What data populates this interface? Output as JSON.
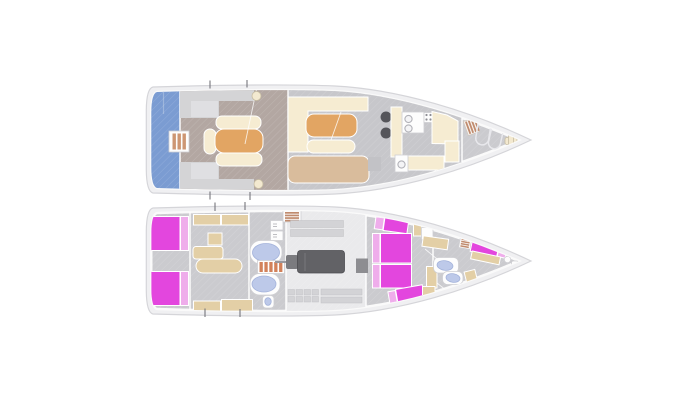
{
  "diagram": {
    "title": "Sailing yacht deck plans",
    "views": [
      {
        "id": "upper-deck",
        "label": "Upper deck / exterior and saloon plan",
        "features": [
          "swim-platform",
          "boarding-ladder",
          "cockpit-bench-seating",
          "cockpit-sunpad",
          "helm-winches",
          "saloon-settee",
          "saloon-table",
          "saloon-sofa",
          "galley-stove",
          "galley-sink",
          "galley-counters",
          "companionway-steps",
          "foredeck-hatches",
          "anchor-windlass"
        ]
      },
      {
        "id": "lower-deck",
        "label": "Lower deck / accommodation plan",
        "features": [
          "aft-cabin-berths",
          "wardrobes",
          "bathtub",
          "shower-tub",
          "companion-stairs",
          "toilet",
          "engine-room",
          "main-engine",
          "storage-grid",
          "guest-cabin-berths",
          "forward-double-berths",
          "washbasins",
          "bow-v-berth",
          "louvered-lockers"
        ]
      }
    ]
  },
  "palette": {
    "canvas": "#ffffff",
    "hullOuter": "#f0f0f2",
    "hullStroke": "#d5d5d9",
    "rim": "#fafafa",
    "deck": "#cbcbcf",
    "floorCockpit": "#b3a7a2",
    "floorSalon": "#c7c7cb",
    "floorEngine": "#eaeaec",
    "blue": "#7b9cd2",
    "stay": "#9db6dc",
    "gray1": "#d4d4d6",
    "gray2": "#dfdfe2",
    "cream": "#f6ecd2",
    "sand": "#e3cfa6",
    "tan": "#d9bc9c",
    "orange": "#e2a563",
    "magenta": "#e346de",
    "pink": "#efadeb",
    "ltblue": "#bdc9e9",
    "ltblueStroke": "#a3b2da",
    "fixture": "#fdfdfd",
    "fixtureStroke": "#cfcfd3",
    "dark": "#55555a",
    "engine": "#626266",
    "engineStroke": "#4c4c50",
    "gearbox": "#7b7b7f",
    "shaft": "#98989e",
    "shelf": "#d3d3d6",
    "shelfStroke": "#c0c0c4",
    "stairOrange": "#d2815a",
    "louverBrown": "#c08b6e",
    "ladderStripe": "#cd9673",
    "winch": "#f3e9d0",
    "winchStroke": "#c6bca2",
    "ringStroke": "#b2b2b8",
    "ringFill": "#f4f4f6",
    "tick": "#76767c",
    "hatchOutline": "#e8e8ec",
    "boxGray": "#c2c2c6",
    "darkBox": "#8d8d91"
  }
}
